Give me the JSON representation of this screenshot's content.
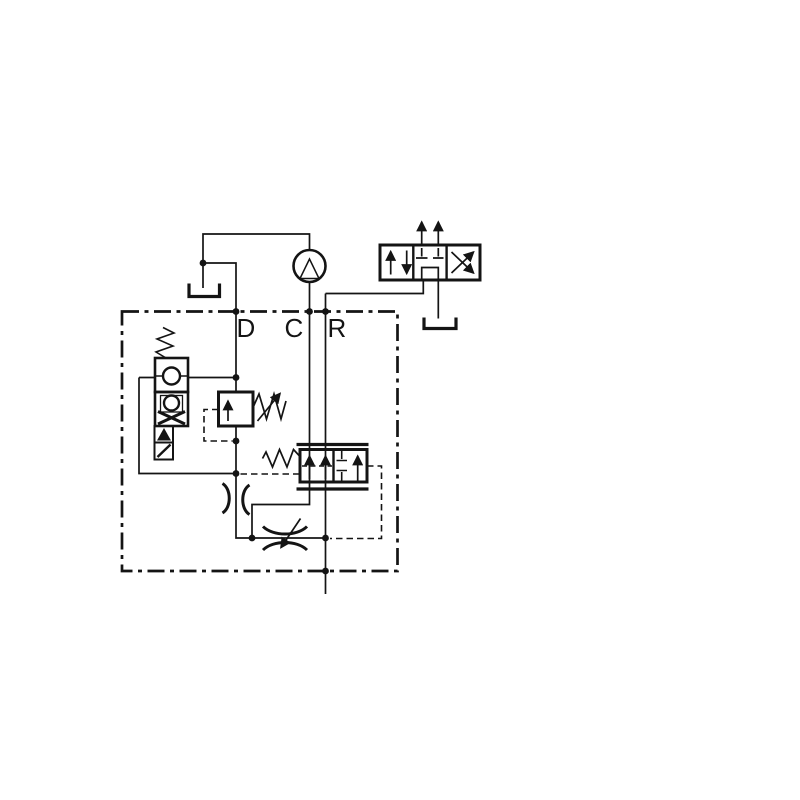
{
  "theme": {
    "background": "#ffffff",
    "line": "#141414"
  },
  "title": "",
  "ports": [
    {
      "id": "D",
      "label": "D"
    },
    {
      "id": "C",
      "label": "C"
    },
    {
      "id": "R",
      "label": "R"
    }
  ],
  "symbols": {
    "pump_motor": "circle-with-up-triangle",
    "tank_left": "open-u-reservoir",
    "tank_right": "open-u-reservoir",
    "directional_valve": "three-position-valve: parallel-arrows | blocked-center | crossed-arrows",
    "check_cartridge": "two-stacked-boxes-with-ball-seat-and-solenoid",
    "solenoid": "box-with-filled-triangle-and-diagonal",
    "relief_valve": "box-up-arrow-with-adjustable-spring",
    "compensator_valve": "two-position-valve-with-springs-and-end-bars",
    "fixed_orifice": "pinch-arcs-on-vertical-line",
    "variable_restrictor": "pinch-arcs-with-diagonal-arrow",
    "boundary": "chain-dash-manifold-box"
  }
}
